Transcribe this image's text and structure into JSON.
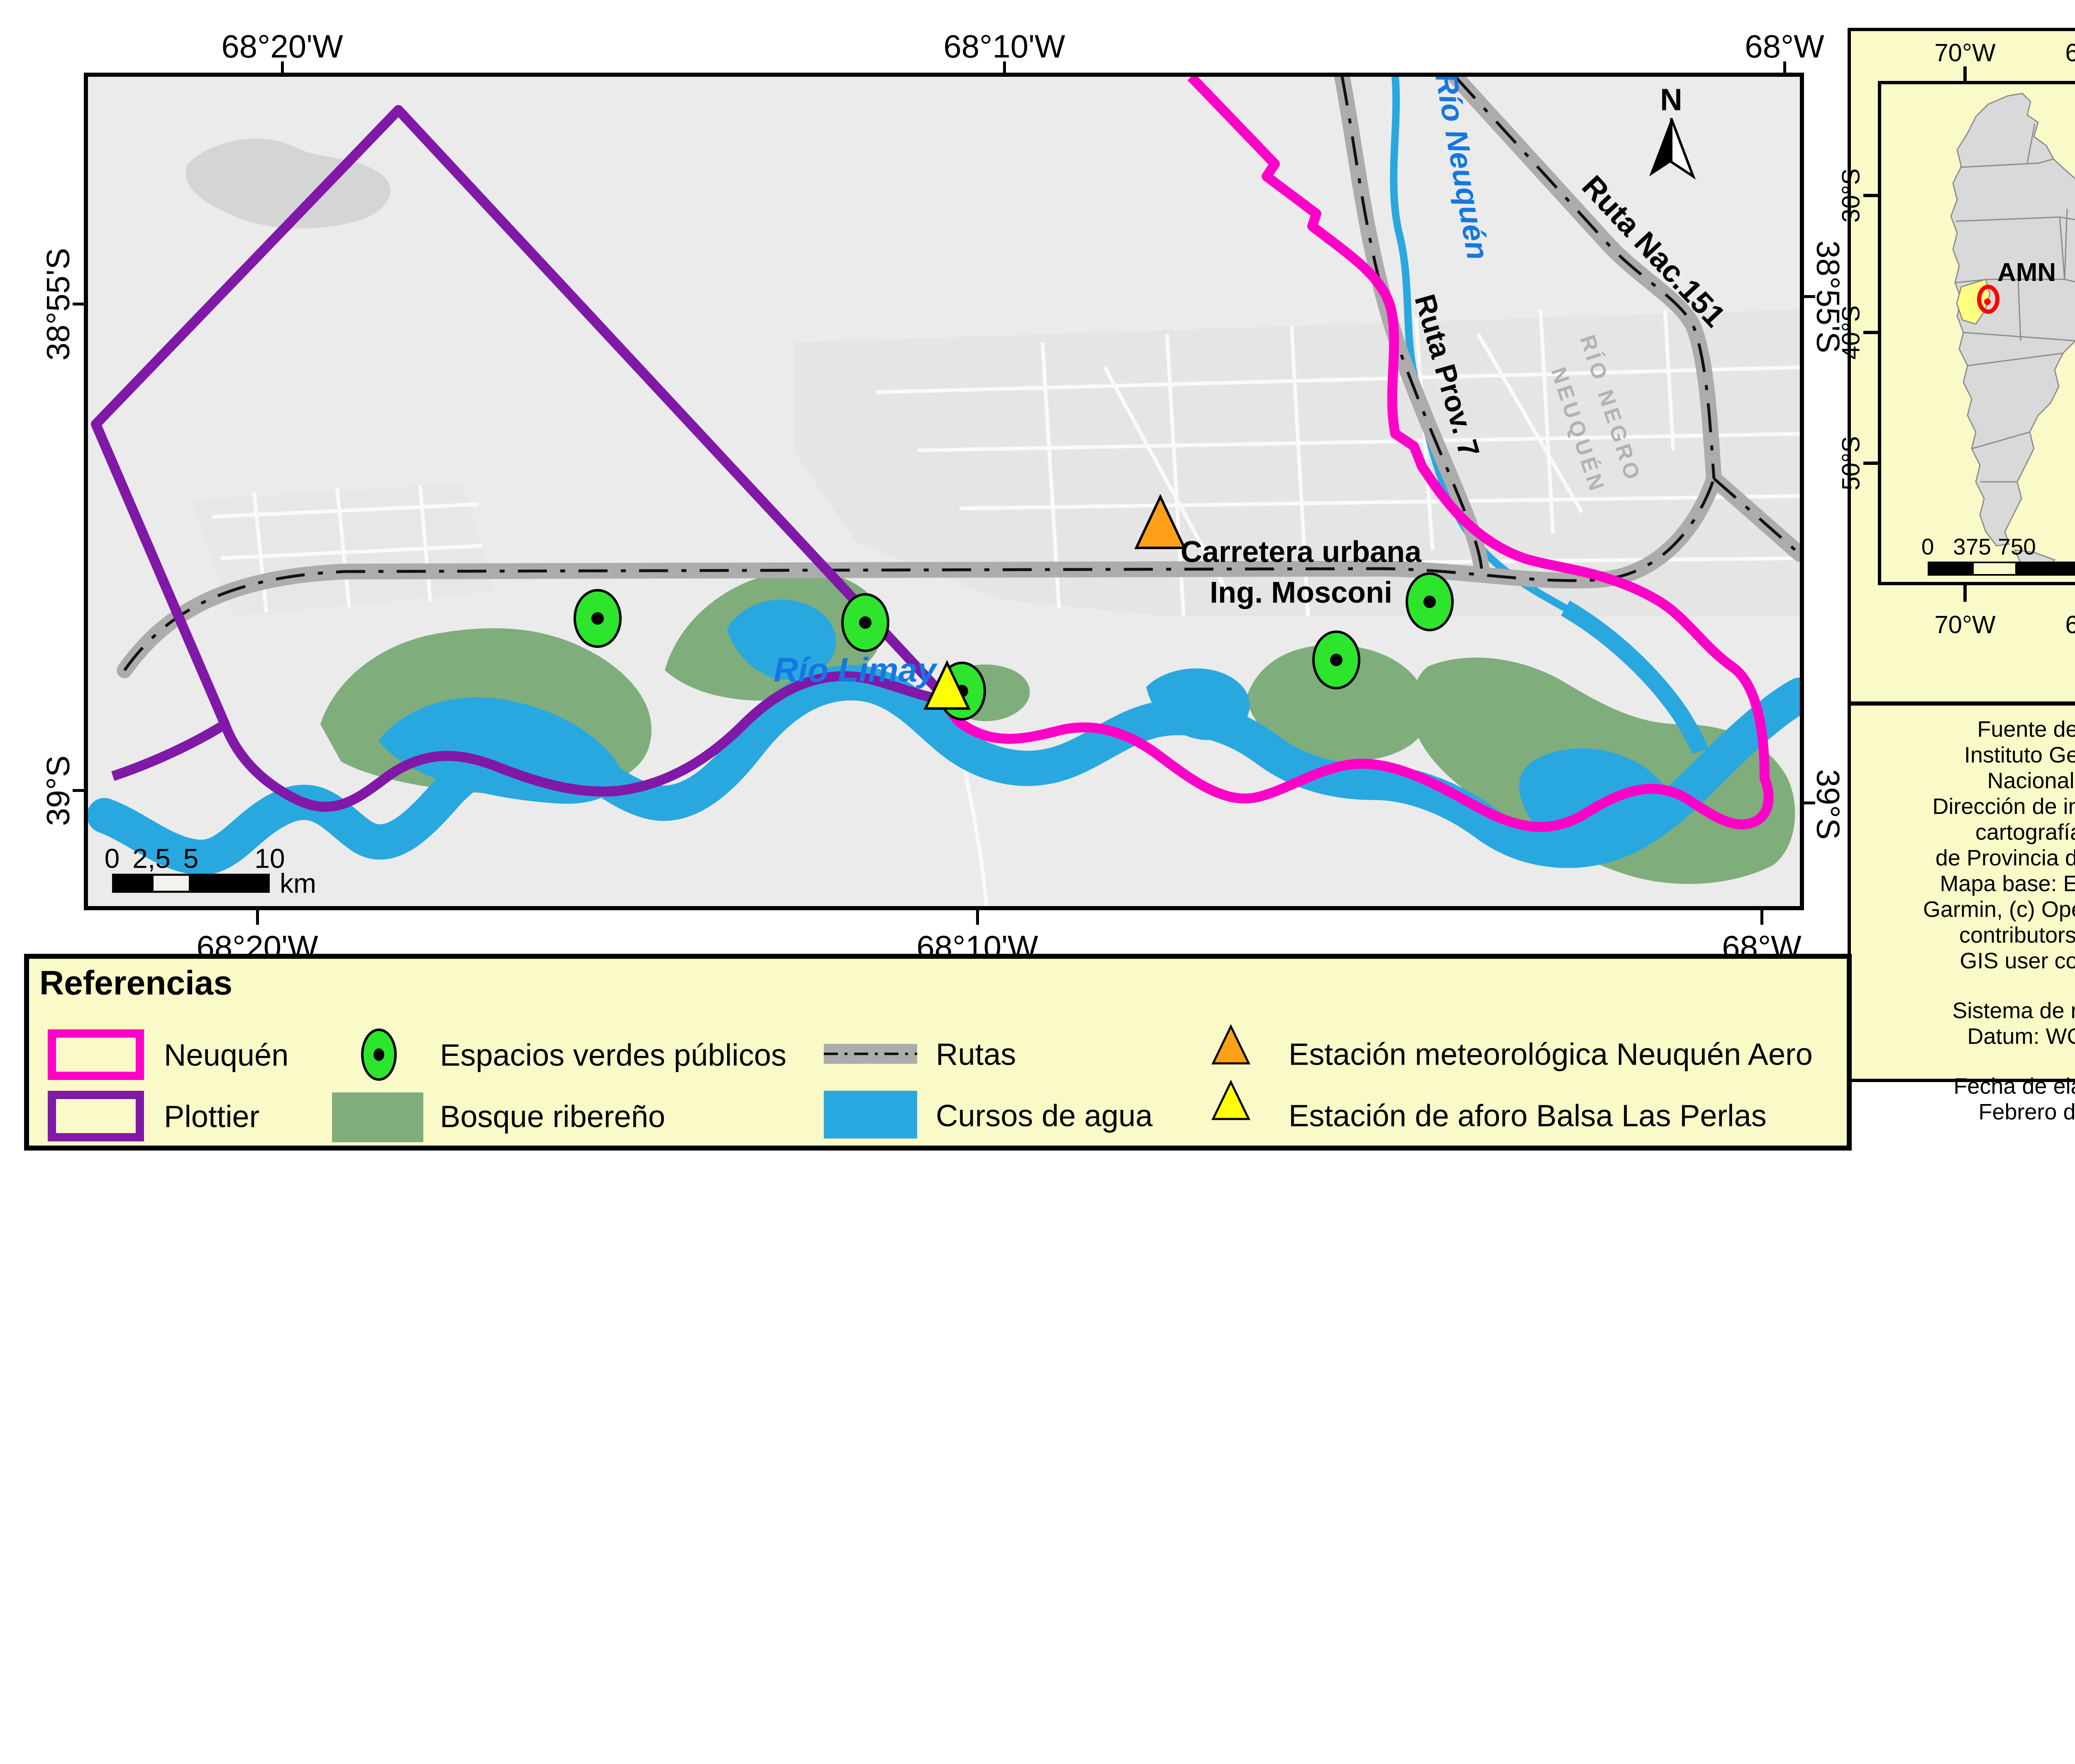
{
  "main_map": {
    "axis_top": [
      "68°20'W",
      "68°10'W",
      "68°W"
    ],
    "axis_bottom": [
      "68°20'W",
      "68°10'W",
      "68°W"
    ],
    "axis_left": [
      "38°55'S",
      "39°S"
    ],
    "axis_right": [
      "38°55'S",
      "39°S"
    ],
    "north_label": "N",
    "scalebar": {
      "t0": "0",
      "t1": "2,5",
      "t2": "5",
      "t3": "10",
      "unit": "km"
    },
    "labels": {
      "rio_neuquen": "Río Neuquén",
      "rio_limay": "Río Limay",
      "ruta_nac": "Ruta Nac.151",
      "ruta_prov": "Ruta Prov. 7",
      "carretera_1": "Carretera urbana",
      "carretera_2": "Ing. Mosconi",
      "rio_negro_faint": "RÍO NEGRO",
      "neuquen_faint": "NEUQUÉN"
    }
  },
  "inset": {
    "axis_top": [
      "70°W",
      "60°W"
    ],
    "axis_bottom": [
      "70°W",
      "60°W"
    ],
    "axis_left": [
      "30°S",
      "40°S",
      "50°S"
    ],
    "axis_right": [
      "30°S",
      "40°S",
      "50°S"
    ],
    "amn_label": "AMN",
    "north_label": "N",
    "scalebar": {
      "t0": "0",
      "t1": "375",
      "t2": "750",
      "t3": "1.500",
      "unit": "km"
    }
  },
  "info_panel": {
    "p1": [
      "Fuente de datos:",
      "Instituto Geográfico",
      "Nacional (IGN)",
      "Dirección de informática y",
      "cartografía digital",
      "de Provincia de Neuquén",
      "Mapa base: Esri, HERE,",
      "Garmin, (c) OpenStreetMap",
      "contributors, and the",
      "GIS user community"
    ],
    "p2": [
      "Sistema de referencia",
      "Datum: WGS 1984"
    ],
    "p3": [
      "Fecha de elaboración",
      "Febrero de 2021"
    ]
  },
  "legend": {
    "title": "Referencias",
    "items": {
      "neuquen": "Neuquén",
      "plottier": "Plottier",
      "espacios": "Espacios verdes públicos",
      "bosque": "Bosque ribereño",
      "rutas": "Rutas",
      "cursos": "Cursos de agua",
      "estacion_meteo": "Estación meteorológica Neuquén Aero",
      "estacion_aforo": "Estación de aforo Balsa Las Perlas"
    }
  },
  "colors": {
    "neuquen_boundary": "#ff00c8",
    "plottier_boundary": "#8018a8",
    "water": "#29a8df",
    "forest": "#7fad7c",
    "green_marker": "#2ee52e",
    "station_orange": "#ffa018",
    "station_yellow": "#ffff00",
    "panel_yellow": "#fafac8",
    "road_gray": "#acacac",
    "map_background": "#ebebeb"
  }
}
